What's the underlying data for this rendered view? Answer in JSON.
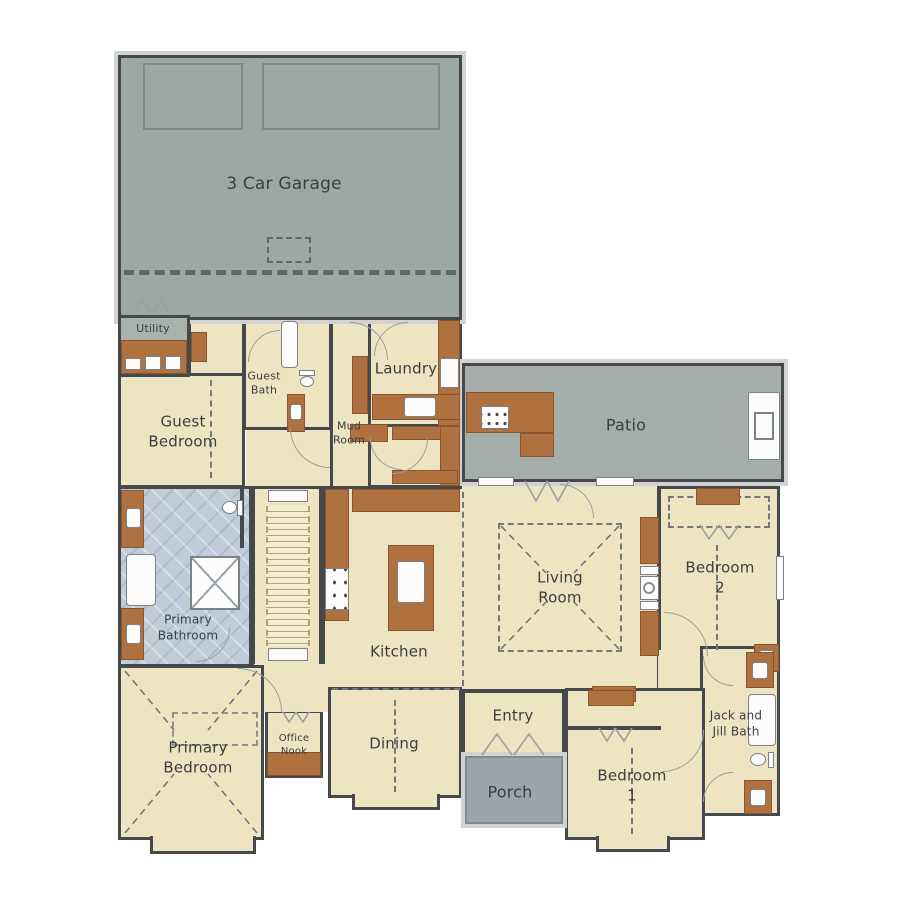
{
  "figure_type": "residential floor plan",
  "rooms": {
    "garage": "3 Car Garage",
    "utility": "Utility",
    "guest_bedroom": "Guest\nBedroom",
    "guest_bath": "Guest\nBath",
    "laundry": "Laundry",
    "mud_room": "Mud\nRoom",
    "patio": "Patio",
    "primary_bathroom": "Primary\nBathroom",
    "living_room": "Living\nRoom",
    "bedroom_2": "Bedroom\n2",
    "kitchen": "Kitchen",
    "jack_jill_bath": "Jack and\nJill Bath",
    "primary_bedroom": "Primary\nBedroom",
    "office_nook": "Office\nNook",
    "dining": "Dining",
    "entry": "Entry",
    "porch": "Porch",
    "bedroom_1": "Bedroom\n1"
  },
  "palette": {
    "floor_cream": "#EDE4C1",
    "garage_gray": "#9EA8A3",
    "patio_gray": "#A5AEAA",
    "porch_gray": "#9CA5A9",
    "utility_gray": "#A9B1AD",
    "bathroom_blue": "#C1CCD9",
    "cabinet_brown": "#B07140",
    "wall_dark": "#45494C",
    "fixture_white": "#FCFCFC",
    "label_text": "#3A3E42",
    "exterior_band": "#D2D2D2"
  }
}
